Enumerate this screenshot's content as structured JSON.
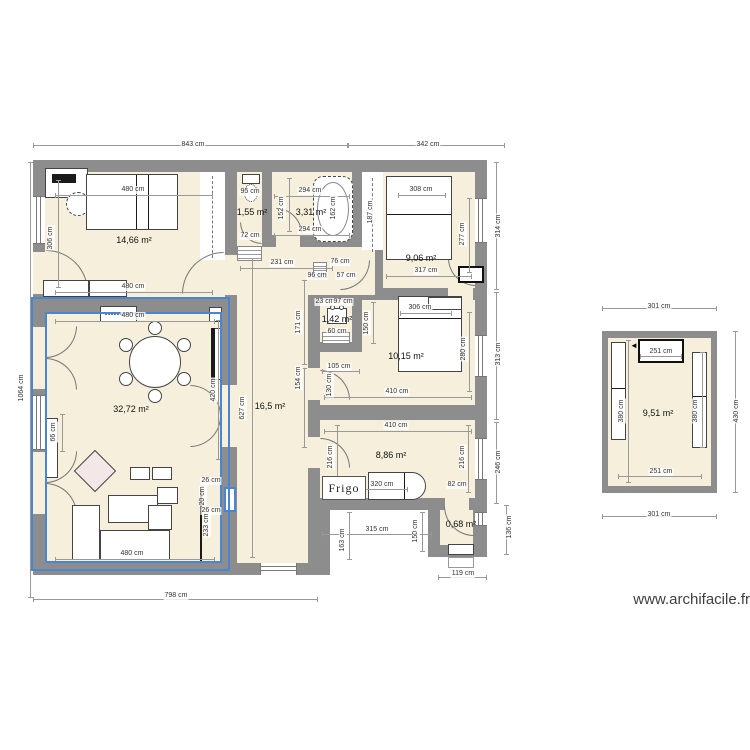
{
  "watermark": "www.archifacile.fr",
  "kitchen": {
    "fridge_label": "Frigo"
  },
  "colors": {
    "wall": "#8d8d8d",
    "floor": "#f5efdb",
    "selection": "#4a86cf"
  },
  "selected_room": "32,72 m²",
  "rooms": [
    {
      "label": "14,66 m²",
      "x": 134,
      "y": 240
    },
    {
      "label": "1,55 m²",
      "x": 252,
      "y": 212
    },
    {
      "label": "3,31 m²",
      "x": 311,
      "y": 212
    },
    {
      "label": "9,06 m²",
      "x": 421,
      "y": 258
    },
    {
      "label": "1,42 m²",
      "x": 337,
      "y": 319
    },
    {
      "label": "10,15 m²",
      "x": 406,
      "y": 356
    },
    {
      "label": "16,5 m²",
      "x": 270,
      "y": 406
    },
    {
      "label": "32,72 m²",
      "x": 131,
      "y": 409
    },
    {
      "label": "8,86 m²",
      "x": 391,
      "y": 455
    },
    {
      "label": "0,68 m²",
      "x": 461,
      "y": 524
    },
    {
      "label": "9,51 m²",
      "x": 658,
      "y": 413
    }
  ],
  "dimensions": [
    {
      "t": "843 cm",
      "x": 193,
      "y": 145
    },
    {
      "t": "342 cm",
      "x": 428,
      "y": 145
    },
    {
      "t": "1064 cm",
      "x": 22,
      "y": 388,
      "r": 1
    },
    {
      "t": "798 cm",
      "x": 176,
      "y": 596
    },
    {
      "t": "119 cm",
      "x": 463,
      "y": 574
    },
    {
      "t": "314 cm",
      "x": 499,
      "y": 226,
      "r": 1
    },
    {
      "t": "313 cm",
      "x": 499,
      "y": 354,
      "r": 1
    },
    {
      "t": "246 cm",
      "x": 499,
      "y": 462,
      "r": 1
    },
    {
      "t": "136 cm",
      "x": 510,
      "y": 527,
      "r": 1
    },
    {
      "t": "480 cm",
      "x": 133,
      "y": 190
    },
    {
      "t": "480 cm",
      "x": 133,
      "y": 287
    },
    {
      "t": "306 cm",
      "x": 51,
      "y": 238,
      "r": 1
    },
    {
      "t": "95 cm",
      "x": 250,
      "y": 192
    },
    {
      "t": "72 cm",
      "x": 250,
      "y": 236
    },
    {
      "t": "294 cm",
      "x": 310,
      "y": 191
    },
    {
      "t": "294 cm",
      "x": 310,
      "y": 230
    },
    {
      "t": "152 cm",
      "x": 282,
      "y": 208,
      "r": 1
    },
    {
      "t": "162 cm",
      "x": 334,
      "y": 208,
      "r": 1
    },
    {
      "t": "231 cm",
      "x": 282,
      "y": 263
    },
    {
      "t": "76 cm",
      "x": 340,
      "y": 262
    },
    {
      "t": "96 cm",
      "x": 317,
      "y": 276
    },
    {
      "t": "57 cm",
      "x": 346,
      "y": 276
    },
    {
      "t": "187 cm",
      "x": 371,
      "y": 212,
      "r": 1
    },
    {
      "t": "308 cm",
      "x": 421,
      "y": 190
    },
    {
      "t": "277 cm",
      "x": 463,
      "y": 234,
      "r": 1
    },
    {
      "t": "317 cm",
      "x": 426,
      "y": 271
    },
    {
      "t": "23 cm",
      "x": 325,
      "y": 302
    },
    {
      "t": "97 cm",
      "x": 343,
      "y": 302
    },
    {
      "t": "60 cm",
      "x": 337,
      "y": 332
    },
    {
      "t": "150 cm",
      "x": 367,
      "y": 323,
      "r": 1
    },
    {
      "t": "306 cm",
      "x": 420,
      "y": 308
    },
    {
      "t": "280 cm",
      "x": 464,
      "y": 349,
      "r": 1
    },
    {
      "t": "410 cm",
      "x": 397,
      "y": 392
    },
    {
      "t": "105 cm",
      "x": 339,
      "y": 367
    },
    {
      "t": "130 cm",
      "x": 330,
      "y": 385,
      "r": 1
    },
    {
      "t": "171 cm",
      "x": 299,
      "y": 322,
      "r": 1
    },
    {
      "t": "154 cm",
      "x": 299,
      "y": 378,
      "r": 1
    },
    {
      "t": "627 cm",
      "x": 243,
      "y": 408,
      "r": 1
    },
    {
      "t": "420 cm",
      "x": 214,
      "y": 390,
      "r": 1
    },
    {
      "t": "26 cm",
      "x": 211,
      "y": 481
    },
    {
      "t": "20 cm",
      "x": 203,
      "y": 496,
      "r": 1
    },
    {
      "t": "26 cm",
      "x": 211,
      "y": 511
    },
    {
      "t": "233 cm",
      "x": 207,
      "y": 525,
      "r": 1
    },
    {
      "t": "66 cm",
      "x": 54,
      "y": 432,
      "r": 1
    },
    {
      "t": "480 cm",
      "x": 133,
      "y": 316
    },
    {
      "t": "480 cm",
      "x": 132,
      "y": 554
    },
    {
      "t": "410 cm",
      "x": 396,
      "y": 426
    },
    {
      "t": "216 cm",
      "x": 331,
      "y": 457,
      "r": 1
    },
    {
      "t": "216 cm",
      "x": 463,
      "y": 457,
      "r": 1
    },
    {
      "t": "320 cm",
      "x": 382,
      "y": 485
    },
    {
      "t": "82 cm",
      "x": 457,
      "y": 485
    },
    {
      "t": "315 cm",
      "x": 377,
      "y": 530
    },
    {
      "t": "163 cm",
      "x": 343,
      "y": 540,
      "r": 1
    },
    {
      "t": "150 cm",
      "x": 416,
      "y": 531,
      "r": 1
    },
    {
      "t": "301 cm",
      "x": 659,
      "y": 307
    },
    {
      "t": "301 cm",
      "x": 659,
      "y": 515
    },
    {
      "t": "430 cm",
      "x": 737,
      "y": 411,
      "r": 1
    },
    {
      "t": "251 cm",
      "x": 661,
      "y": 352
    },
    {
      "t": "251 cm",
      "x": 661,
      "y": 472
    },
    {
      "t": "380 cm",
      "x": 622,
      "y": 411,
      "r": 1
    },
    {
      "t": "380 cm",
      "x": 696,
      "y": 411,
      "r": 1
    }
  ]
}
